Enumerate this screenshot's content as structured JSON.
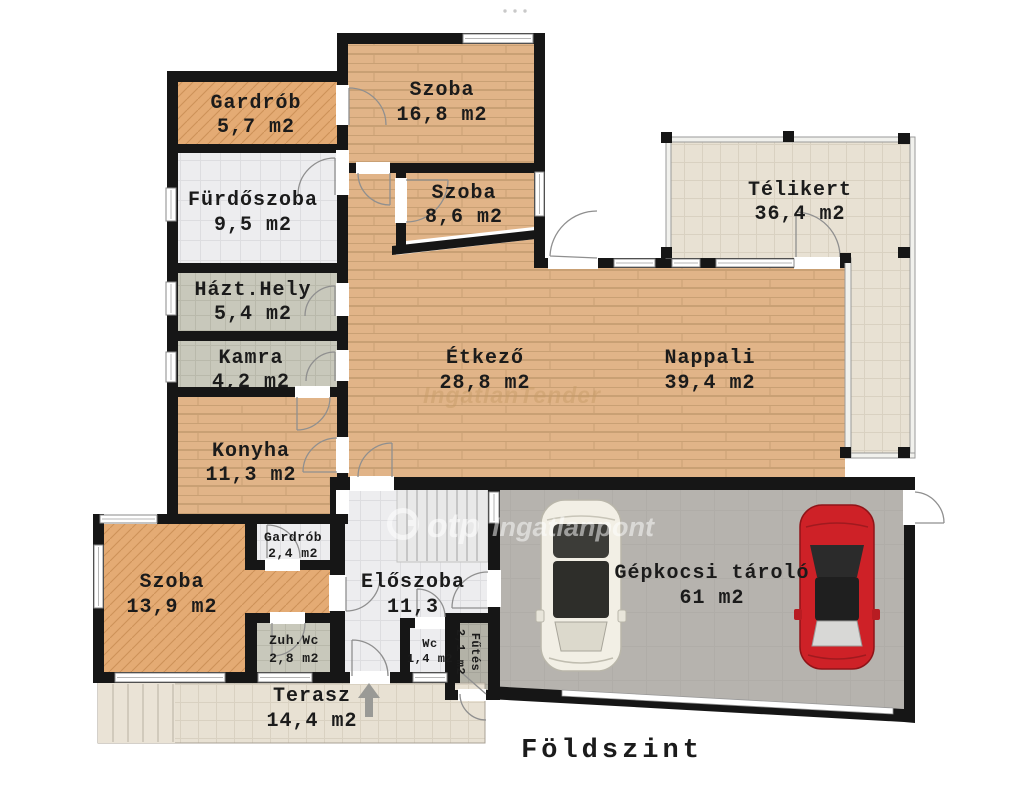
{
  "plan": {
    "title": "Földszint",
    "watermark": {
      "brand": "otp",
      "suffix": "Ingatlanpont",
      "faint": "IngatlanTender"
    },
    "rooms": [
      {
        "id": "gardrob-felso",
        "name": "Gardrób",
        "area": "5,7 m2"
      },
      {
        "id": "szoba-nagy",
        "name": "Szoba",
        "area": "16,8 m2"
      },
      {
        "id": "furdoszoba",
        "name": "Fürdőszoba",
        "area": "9,5 m2"
      },
      {
        "id": "szoba-kis",
        "name": "Szoba",
        "area": "8,6 m2"
      },
      {
        "id": "telikert",
        "name": "Télikert",
        "area": "36,4 m2"
      },
      {
        "id": "hazt-hely",
        "name": "Házt.Hely",
        "area": "5,4 m2"
      },
      {
        "id": "kamra",
        "name": "Kamra",
        "area": "4,2 m2"
      },
      {
        "id": "etkezo",
        "name": "Étkező",
        "area": "28,8 m2"
      },
      {
        "id": "nappali",
        "name": "Nappali",
        "area": "39,4 m2"
      },
      {
        "id": "konyha",
        "name": "Konyha",
        "area": "11,3 m2"
      },
      {
        "id": "gardrob-also",
        "name": "Gardrób",
        "area": "2,4 m2"
      },
      {
        "id": "szoba-also",
        "name": "Szoba",
        "area": "13,9 m2"
      },
      {
        "id": "eloszoba",
        "name": "Előszoba",
        "area": "11,3"
      },
      {
        "id": "zuh-wc",
        "name": "Zuh.Wc",
        "area": "2,8 m2"
      },
      {
        "id": "wc",
        "name": "Wc",
        "area": "1,4 m2"
      },
      {
        "id": "futes",
        "name": "Fűtés",
        "area": "2,1 m2"
      },
      {
        "id": "gepkocsi",
        "name": "Gépkocsi tároló",
        "area": "61 m2"
      },
      {
        "id": "terasz",
        "name": "Terasz",
        "area": "14,4 m2"
      }
    ],
    "colors": {
      "wood": "#e1b488",
      "wood_line": "#c9a074",
      "herringbone": "#e4ab74",
      "herringbone_line": "#cd9258",
      "tile_light": "#ededef",
      "tile_warm": "#e8e1d3",
      "tile_gray": "#c8c8bb",
      "tile_dark": "#b3b2a7",
      "garage_floor": "#b6b3ae",
      "wall": "#161616",
      "car_red": "#ce2127",
      "car_white": "#f2efe5"
    }
  }
}
